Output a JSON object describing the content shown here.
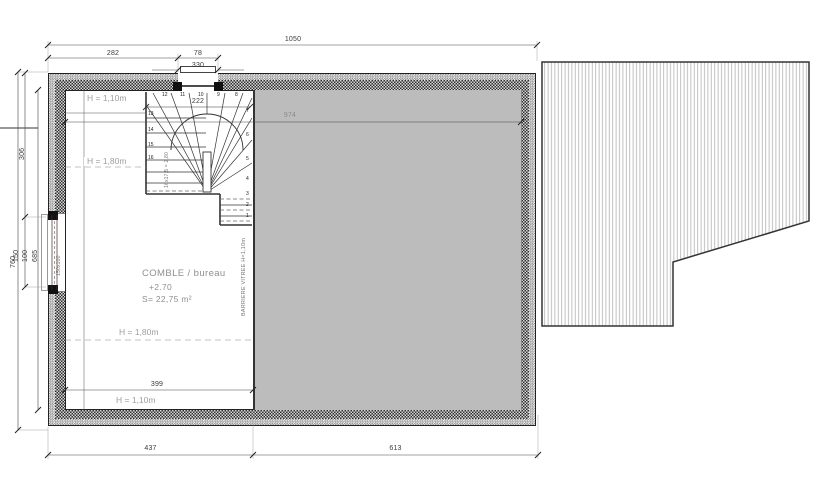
{
  "plan": {
    "room": {
      "name": "COMBLE / bureau",
      "level": "+2.70",
      "area": "S= 22,75 m²"
    },
    "heights": {
      "top": "H = 1,10m",
      "upper": "H = 1,80m",
      "lower": "H = 1,80m",
      "bottom": "H = 1,10m"
    },
    "dims": {
      "top_total": "1050",
      "top_left": "282",
      "top_opening": "78",
      "top_window": "330",
      "left_total": "760",
      "left_upper": "306",
      "window_height": "150",
      "window_sill": "100",
      "interior_height": "685",
      "interior_width": "974",
      "stair_width": "222",
      "room_width": "399",
      "bottom_left": "437",
      "bottom_right": "613"
    },
    "annotations": {
      "barrier": "BARRIERE VITREE H=1,10m",
      "window_label": "150x100",
      "stair_note": "16x17,5 = 2,80"
    },
    "stair_steps": [
      {
        "n": "1"
      },
      {
        "n": "2"
      },
      {
        "n": "3"
      },
      {
        "n": "4"
      },
      {
        "n": "5"
      },
      {
        "n": "6"
      },
      {
        "n": "7"
      },
      {
        "n": "8"
      },
      {
        "n": "9"
      },
      {
        "n": "10"
      },
      {
        "n": "11"
      },
      {
        "n": "12"
      },
      {
        "n": "13"
      },
      {
        "n": "14"
      },
      {
        "n": "15"
      },
      {
        "n": "16"
      }
    ],
    "colors": {
      "roof_fill": "#bcbcbc",
      "wall_dark": "#2e2e2e",
      "deck_stripe": "#b0b0b0",
      "axis_red": "#b85c5c"
    }
  }
}
